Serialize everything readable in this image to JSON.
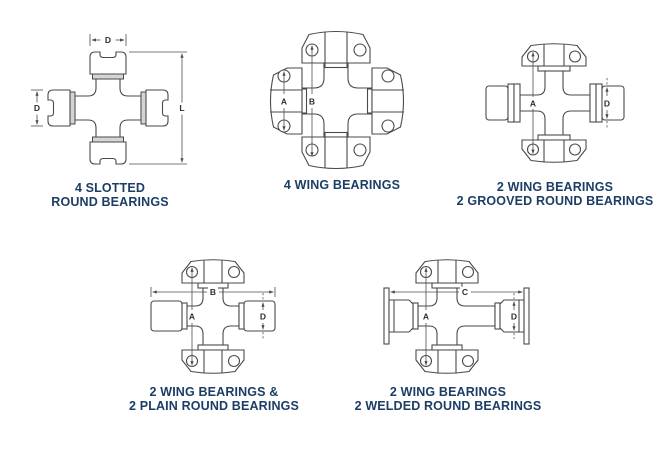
{
  "page": {
    "background_color": "#ffffff",
    "caption_color": "#1c3e66",
    "outline_color": "#4a4a4a",
    "dimension_color": "#2e2e2e",
    "shade_color": "#d4d4d4"
  },
  "figures": [
    {
      "id": "slotted-round",
      "caption_line1": "4 SLOTTED",
      "caption_line2": "ROUND BEARINGS",
      "dims": {
        "d_top": "D",
        "d_left": "D",
        "l_right": "L"
      }
    },
    {
      "id": "four-wing",
      "caption_line1": "4 WING BEARINGS",
      "caption_line2": "",
      "dims": {
        "a": "A",
        "b": "B"
      }
    },
    {
      "id": "wing-grooved-round",
      "caption_line1": "2 WING BEARINGS",
      "caption_line2": "2 GROOVED ROUND BEARINGS",
      "dims": {
        "a": "A",
        "d": "D"
      }
    },
    {
      "id": "wing-plain-round",
      "caption_line1": "2 WING BEARINGS &",
      "caption_line2": "2 PLAIN ROUND BEARINGS",
      "dims": {
        "a": "A",
        "b": "B",
        "d": "D"
      }
    },
    {
      "id": "wing-welded-round",
      "caption_line1": "2 WING BEARINGS",
      "caption_line2": "2 WELDED ROUND BEARINGS",
      "dims": {
        "a": "A",
        "c": "C",
        "d": "D"
      }
    }
  ]
}
